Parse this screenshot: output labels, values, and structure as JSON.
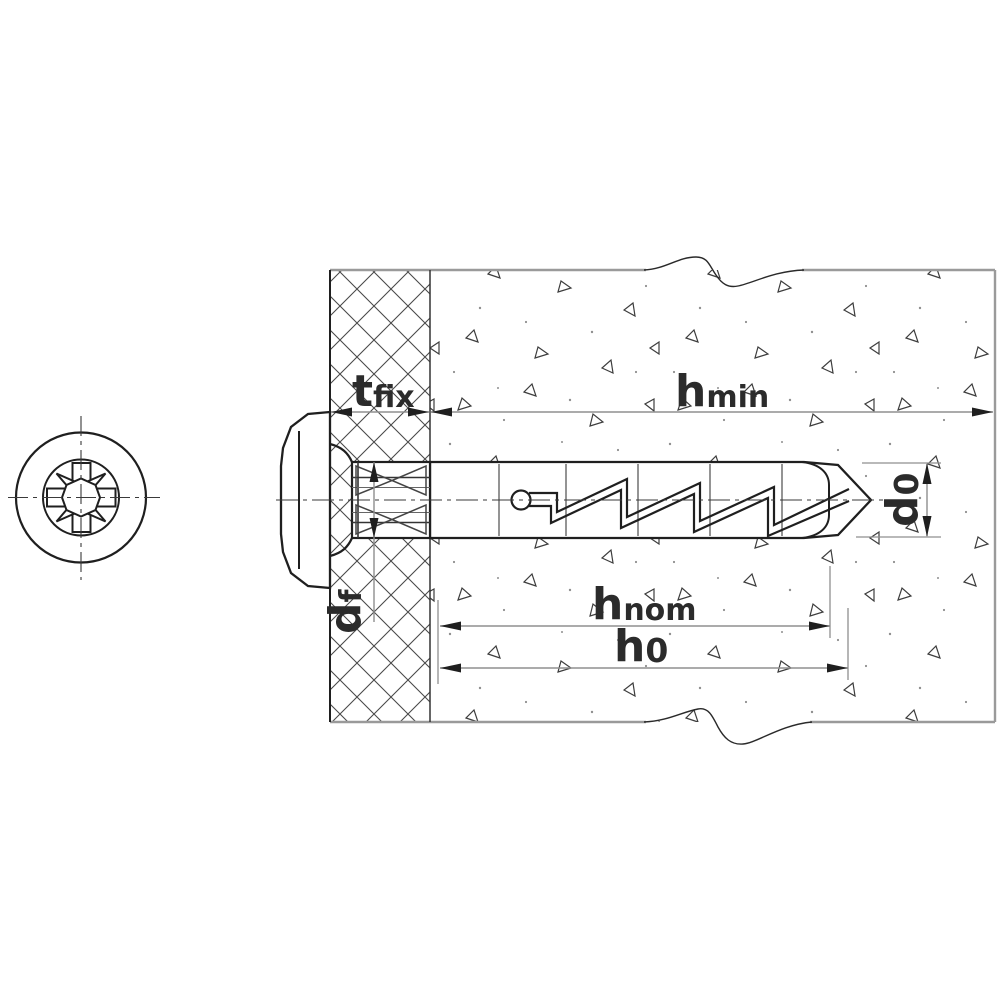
{
  "drawing": {
    "background": "#ffffff",
    "colors": {
      "outline": "#1f1f1f",
      "dim_line": "#8f8f8f",
      "wall_edge": "#9a9a9a",
      "division_line": "#7a7a7a",
      "text": "#2b2b2b"
    },
    "dimensions": {
      "t_fix": {
        "main": "t",
        "sub": "fix"
      },
      "h_min": {
        "main": "h",
        "sub": "min"
      },
      "h_nom": {
        "main": "h",
        "sub": "nom"
      },
      "h_0": {
        "main": "h",
        "sub": "0"
      },
      "d_0": {
        "main": "d",
        "sub": "0"
      },
      "d_f": {
        "main": "d",
        "sub": "f"
      }
    }
  }
}
